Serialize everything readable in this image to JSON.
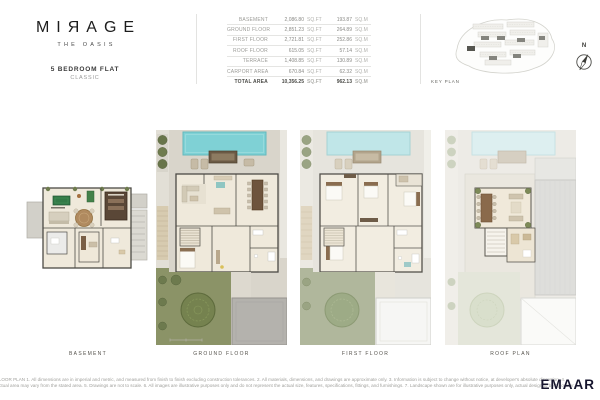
{
  "header": {
    "logo_title": "MIЯAGE",
    "logo_subtitle": "THE OASIS",
    "unit_type": "5 BEDROOM FLAT",
    "unit_variant": "CLASSIC"
  },
  "area_table": {
    "sqft_unit": "SQ.FT",
    "sqm_unit": "SQ.M",
    "rows": [
      {
        "label": "BASEMENT",
        "sqft": "2,086.80",
        "sqm": "193.87"
      },
      {
        "label": "GROUND FLOOR",
        "sqft": "2,851.23",
        "sqm": "264.89"
      },
      {
        "label": "FIRST FLOOR",
        "sqft": "2,721.81",
        "sqm": "252.86"
      },
      {
        "label": "ROOF FLOOR",
        "sqft": "615.05",
        "sqm": "57.14"
      },
      {
        "label": "TERRACE",
        "sqft": "1,408.85",
        "sqm": "130.89"
      },
      {
        "label": "CARPORT AREA",
        "sqft": "670.84",
        "sqm": "62.32"
      },
      {
        "label": "TOTAL AREA",
        "sqft": "10,356.25",
        "sqm": "962.13"
      }
    ]
  },
  "key_plan": {
    "label": "KEY PLAN",
    "compass_label": "N"
  },
  "plans": {
    "basement_label": "BASEMENT",
    "ground_label": "GROUND FLOOR",
    "first_label": "FIRST FLOOR",
    "roof_label": "ROOF PLAN"
  },
  "footer": {
    "disclaimer_line1": "FLOOR PLAN 1. All dimensions are in imperial and metric, and measured from finish to finish excluding construction tolerances. 2. All materials, dimensions, and drawings are approximate only. 3. Information is subject to change without notice, at developer's absolute discretion. 4.",
    "disclaimer_line2": "Actual area may vary from the stated area. 5. Drawings are not to scale. 6. All images are illustrative purposes only and do not represent the actual size, features, specifications, fittings, and furnishings. 7. Landscape shown are for illustrative purposes only, actual design to be by owner.",
    "brand": "EMAAR"
  },
  "colors": {
    "pool_teal": "#7fd1d5",
    "pool_teal_muted": "#c0e6e8",
    "garden_green": "#8b9367",
    "garden_sage": "#b0b79c",
    "floor_cream": "#efe9db",
    "site_greige": "#d9d5cb",
    "wall_dark": "#4c4a45",
    "brand_dark": "#16152e"
  }
}
